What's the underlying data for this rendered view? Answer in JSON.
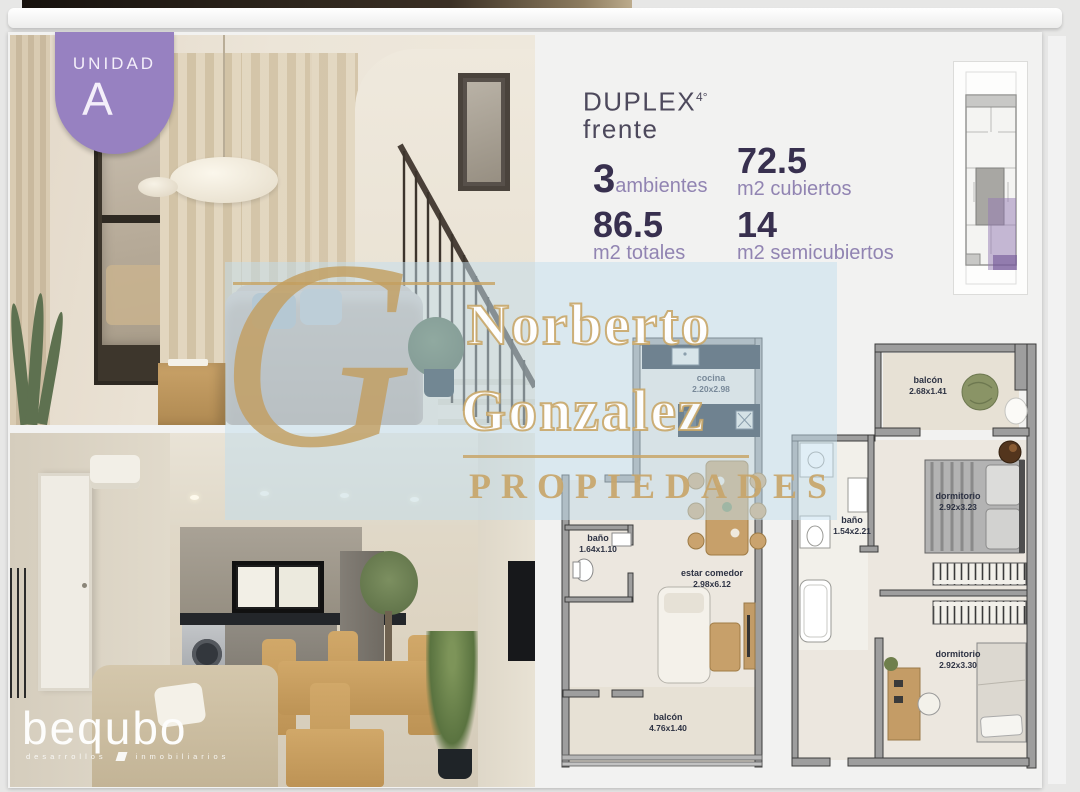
{
  "unit_badge": {
    "label": "UNIDAD",
    "unit": "A"
  },
  "header": {
    "type": "DUPLEX",
    "floor": "4°",
    "orientation": "frente"
  },
  "stats": {
    "ambientes": {
      "value": "3",
      "label": "ambientes"
    },
    "cubiertos": {
      "value": "72.5",
      "label": "m2 cubiertos"
    },
    "totales": {
      "value": "86.5",
      "label": "m2 totales"
    },
    "semicubiertos": {
      "value": "14",
      "label": "m2 semicubiertos"
    }
  },
  "plans": {
    "lower": {
      "rooms": [
        {
          "name": "cocina",
          "dims": "2.20x2.98"
        },
        {
          "name": "baño",
          "dims": "1.64x1.10"
        },
        {
          "name": "estar comedor",
          "dims": "2.98x6.12"
        },
        {
          "name": "balcón",
          "dims": "4.76x1.40"
        }
      ]
    },
    "upper": {
      "rooms": [
        {
          "name": "balcón",
          "dims": "2.68x1.41"
        },
        {
          "name": "baño",
          "dims": "1.54x2.21"
        },
        {
          "name": "dormitorio",
          "dims": "2.92x3.23"
        },
        {
          "name": "dormitorio",
          "dims": "2.92x3.30"
        }
      ]
    }
  },
  "watermark": {
    "monogram": "G",
    "name_line1": "Norberto",
    "name_line2": "Gonzalez",
    "subtitle": "PROPIEDADES"
  },
  "developer_logo": {
    "name": "bequbo",
    "tagline_word1": "desarrollos",
    "tagline_word2": "inmobiliarios"
  },
  "colors": {
    "accent_purple": "#9781c1",
    "stat_number": "#38304f",
    "stat_label": "#9184b2",
    "watermark_gold": "#c8a668",
    "plan_highlight": "#947cb6",
    "kitchen_navy": "#1d2733"
  }
}
